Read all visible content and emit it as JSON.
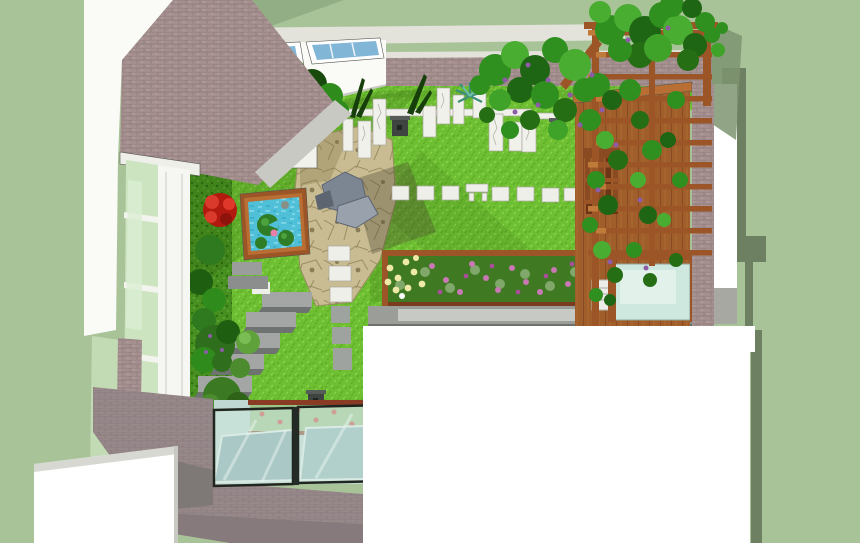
{
  "scene": {
    "alt": "3D rendered top-down perspective of a courtyard roof garden with lawn, flagstone patio, lily pond, stone slab screen, wooden pergola with climbing vines, flower bed and glass balustrade",
    "objects": [
      "brick house facade",
      "tall casement window",
      "skylight windows",
      "lawn",
      "clipped hedge border",
      "red flowering shrubs",
      "square lily pond",
      "flagstone patio with rock sculpture",
      "standing white stone slabs",
      "white paver path",
      "garden steps",
      "stone lanterns",
      "flower bed with wooden edge",
      "concrete path",
      "timber deck wall",
      "wooden chair",
      "pergola trellis with vines",
      "brick pier",
      "glass balustrade over skylight well",
      "white parapet wall"
    ]
  },
  "colors": {
    "bg_sage": "#A9C399",
    "roof_sage": "#92AE84",
    "shadow_olive": "#6E8062",
    "white": "#FFFFFF",
    "wall_white": "#FAFAF7",
    "fascia_light": "#E3E3DC",
    "soffit_gray": "#C9C9C3",
    "skylight_glass": "#82B6D6",
    "brick": "#A5908F",
    "paving_brick": "#97888A",
    "window_glass": "#CDE4C0",
    "pale_green_wall": "#C3DBB5",
    "frame_white": "#F6F6F2",
    "lawn": "#6FBF33",
    "hedge": "#47901F",
    "bed_green": "#3F7A22",
    "flagstone": "#C9BC92",
    "rock_gray": "#7C8693",
    "slab_white": "#F1F1EC",
    "paver_white": "#EFEFE9",
    "step_gray": "#A3A6A4",
    "concrete": "#9B9D99",
    "wood": "#A05E2B",
    "trellis_wood": "#9C5526",
    "chair_wood": "#8A4A22",
    "pond_water": "#4FC0D8",
    "lily_green": "#2F7D26",
    "flower_pink": "#E87FA8",
    "shrub_mid": "#2F8C1C",
    "vine_green": "#2F8F1F",
    "red_flower": "#C8281C",
    "purple_flower": "#8E5BA8",
    "bed_pink": "#C878B4",
    "bed_yellow": "#EFE9A8",
    "glass_pale": "#CEE8DF",
    "skylight_teal": "#7FA3A8",
    "teal_water": "#7FB0B8",
    "planter_green": "#9BC487",
    "lantern": "#3E4440",
    "gray_wall": "#7E7977"
  }
}
